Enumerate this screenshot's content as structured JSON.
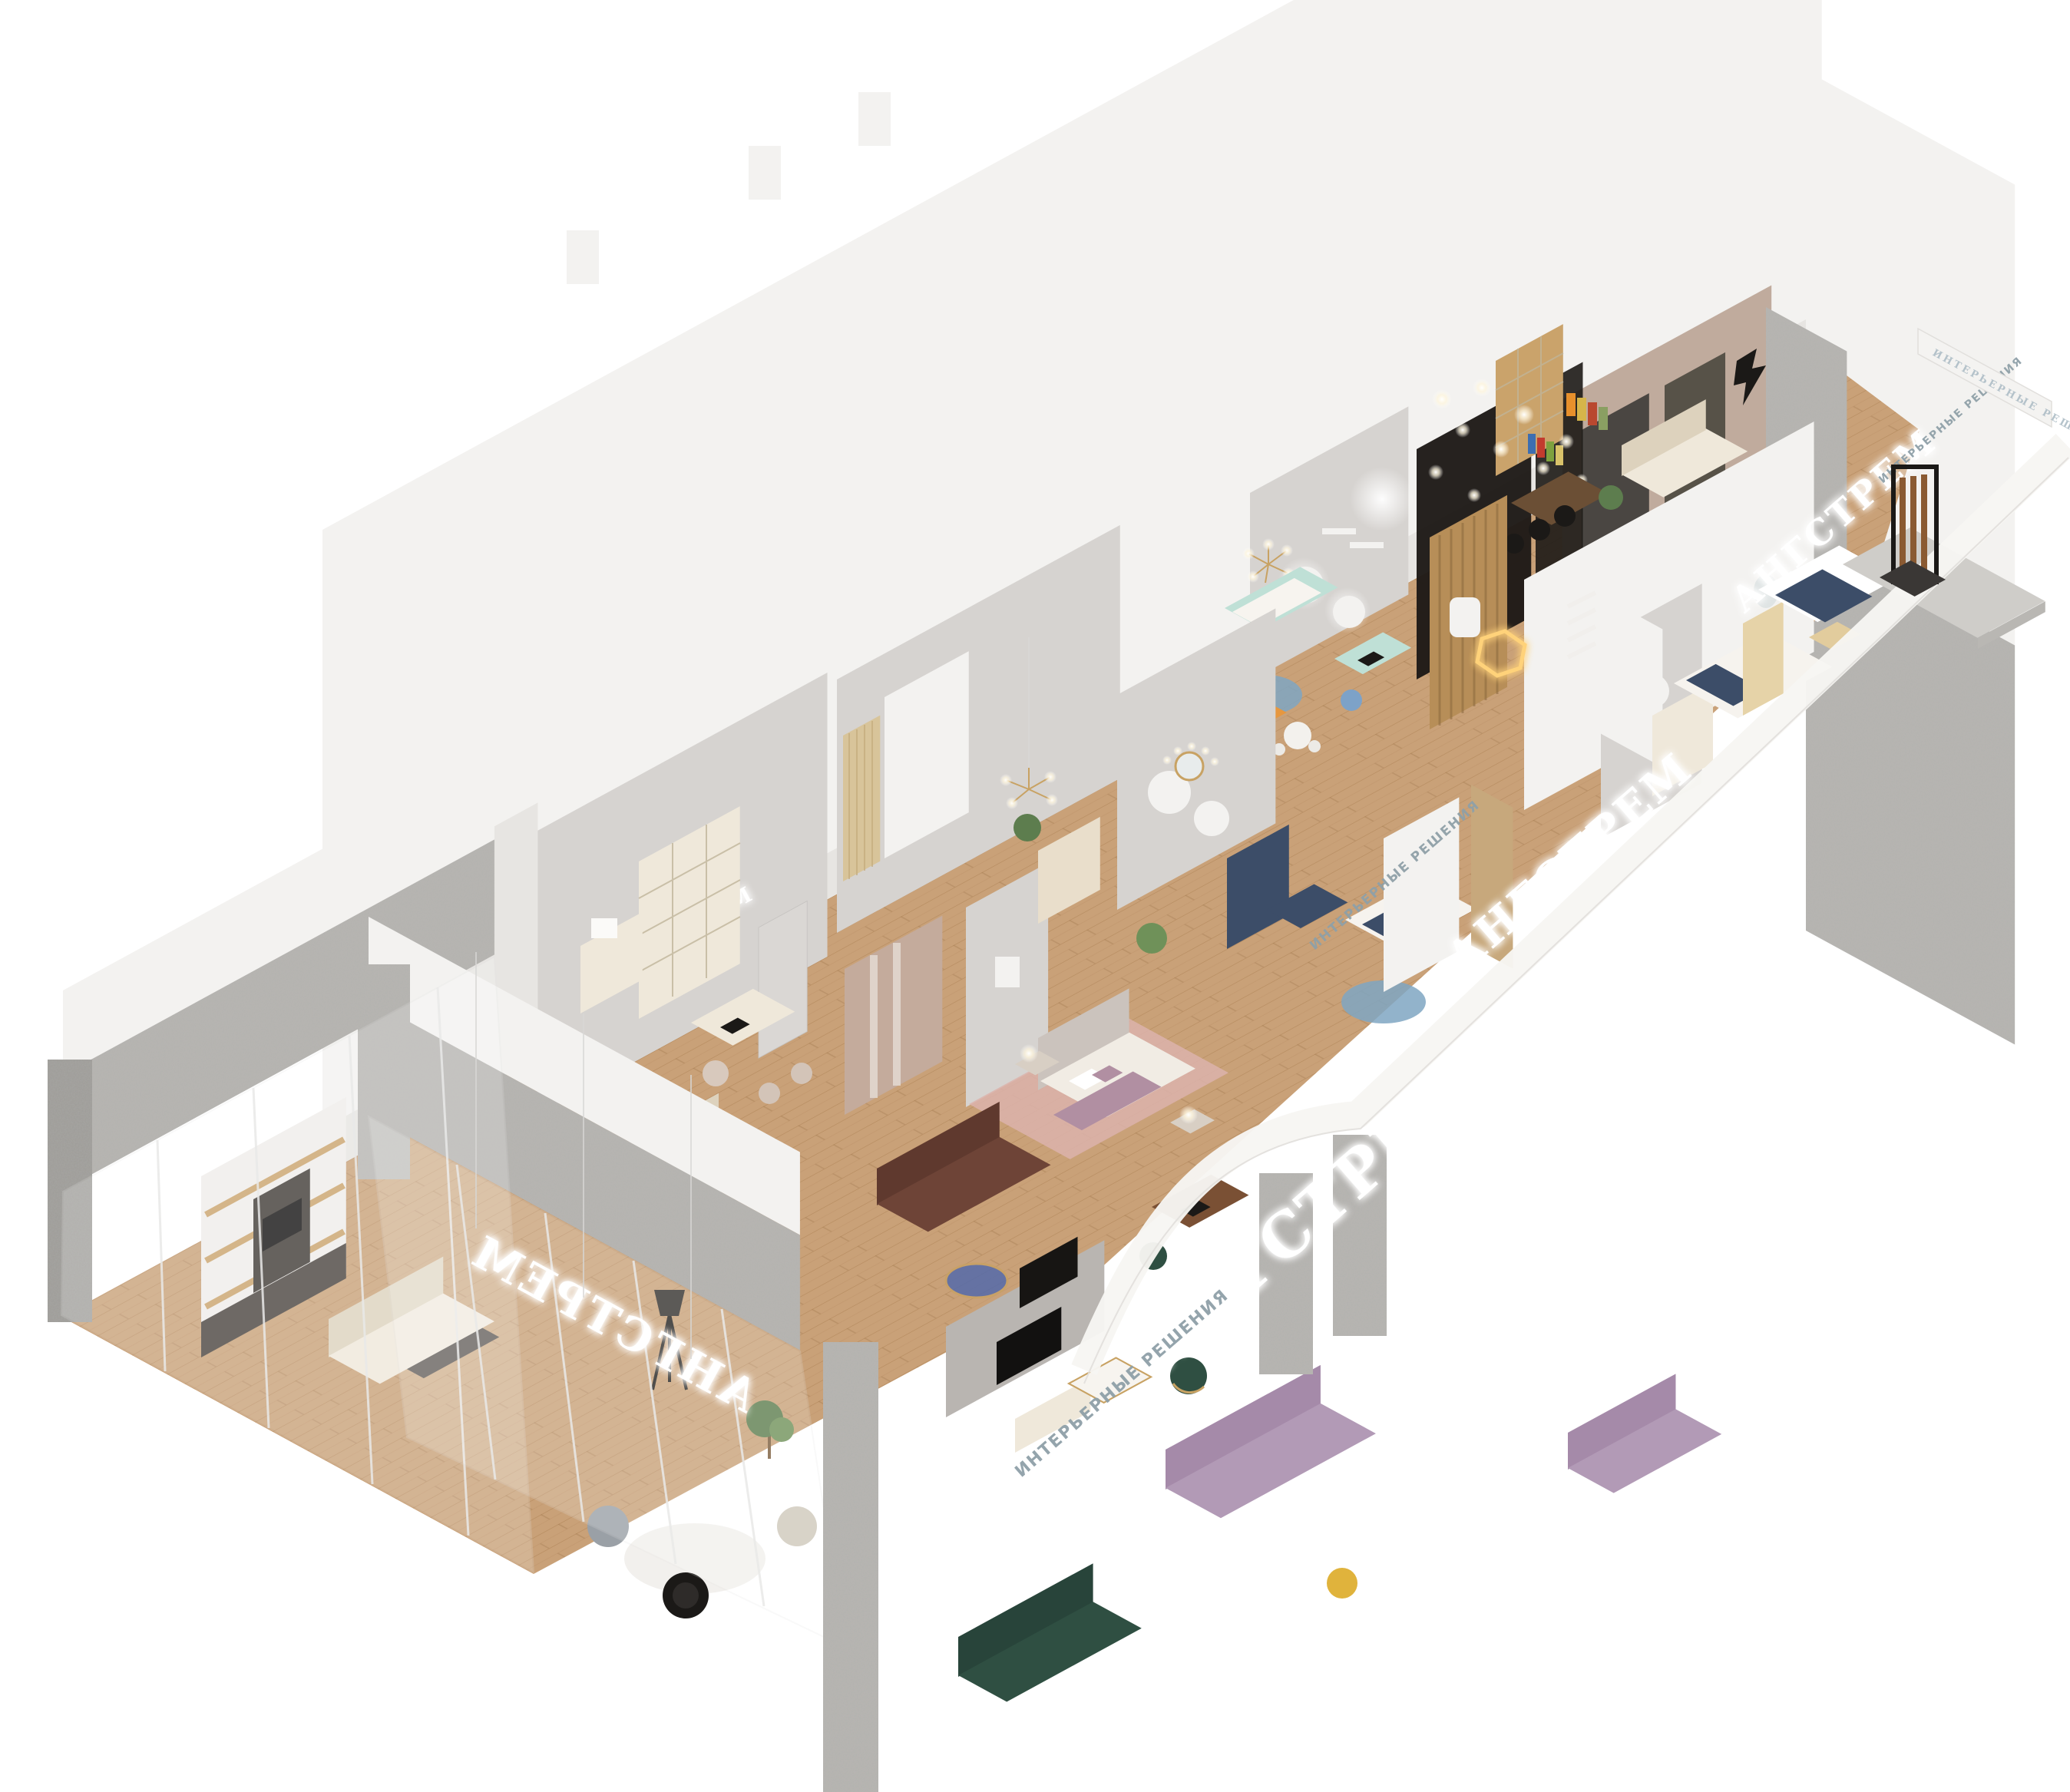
{
  "scene": {
    "kind": "isometric-3d-render",
    "subject": "furniture showroom cutaway model",
    "background": "#ffffff"
  },
  "signage": {
    "brand": "АНГСТРЕМ",
    "tagline": "ИНТЕРЬЕРНЫЕ РЕШЕНИЯ",
    "brand_sign_count": 6,
    "tagline_sign_count": 4,
    "logo_icon": "lightning-arrow-icon"
  },
  "colors": {
    "wood": "#c9a178",
    "wood_dark": "#ab7f51",
    "concrete": "#b8b6b2",
    "concrete_dark": "#9f9d99",
    "wall": "#f3f2f0",
    "wall_shade": "#e7e5e2",
    "wall_gray": "#d6d3d0",
    "taupe": "#c0ab9d",
    "studio_dark": "#1d1916",
    "black": "#1b1917",
    "cream": "#efe8da",
    "cream_dark": "#ddd2bd",
    "mauve": "#b18fa2",
    "lilac": "#b29ab6",
    "green": "#2f4f42",
    "navy": "#3c4d68",
    "mint": "#bfe0d6",
    "blue_glass": "#4a66b0",
    "orange": "#e6973f",
    "brown": "#6e4437",
    "gold": "#c8a263",
    "rug_pink": "#dcb3ac",
    "rug_blue": "#7fa6c2",
    "glow": "#ffffff",
    "sign_metal": "#aebdc6"
  }
}
